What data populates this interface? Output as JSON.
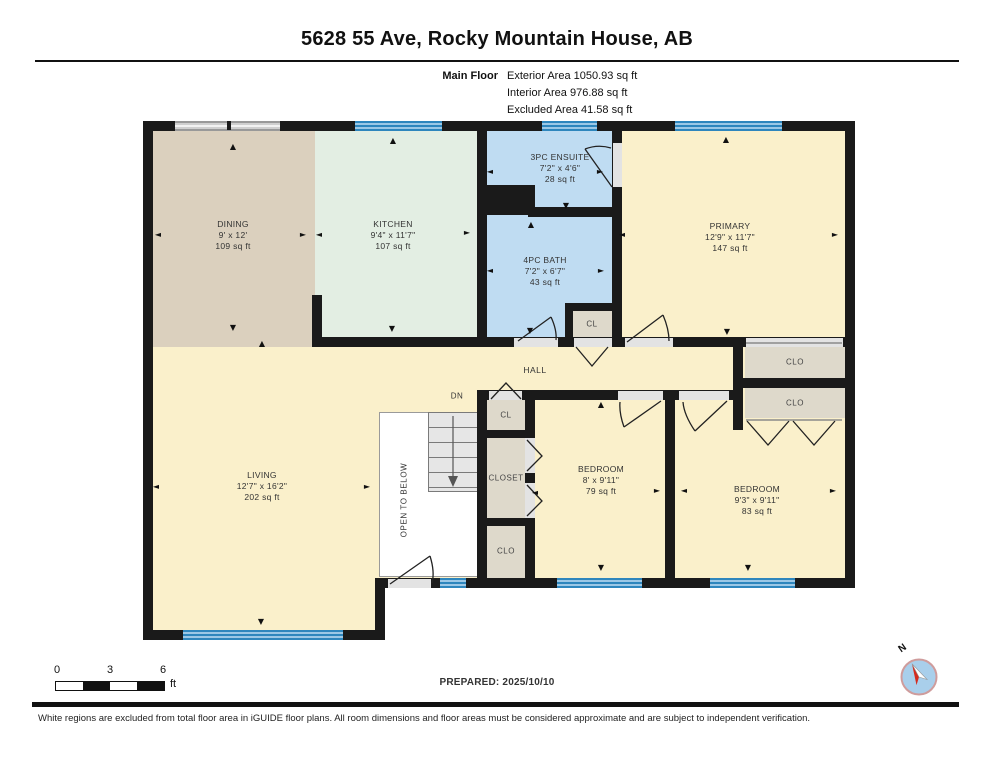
{
  "header": {
    "title": "5628 55 Ave, Rocky Mountain House, AB",
    "floor_label": "Main Floor",
    "stats": [
      "Exterior Area 1050.93 sq ft",
      "Interior Area 976.88 sq ft",
      "Excluded Area 41.58 sq ft"
    ]
  },
  "rooms": {
    "dining": {
      "name": "DINING",
      "dims": "9' x 12'",
      "area": "109 sq ft"
    },
    "kitchen": {
      "name": "KITCHEN",
      "dims": "9'4\" x 11'7\"",
      "area": "107 sq ft"
    },
    "ensuite": {
      "name": "3PC ENSUITE",
      "dims": "7'2\" x 4'6\"",
      "area": "28 sq ft"
    },
    "bath": {
      "name": "4PC BATH",
      "dims": "7'2\" x 6'7\"",
      "area": "43 sq ft"
    },
    "primary": {
      "name": "PRIMARY",
      "dims": "12'9\" x 11'7\"",
      "area": "147 sq ft"
    },
    "living": {
      "name": "LIVING",
      "dims": "12'7\" x 16'2\"",
      "area": "202 sq ft"
    },
    "bedroom1": {
      "name": "BEDROOM",
      "dims": "8' x 9'11\"",
      "area": "79 sq ft"
    },
    "bedroom2": {
      "name": "BEDROOM",
      "dims": "9'3\" x 9'11\"",
      "area": "83 sq ft"
    },
    "hall": {
      "name": "HALL"
    }
  },
  "closets": {
    "cl": "CL",
    "clo": "CLO",
    "closet": "CLOSET"
  },
  "stairs": {
    "dn": "DN",
    "open_to_below": "OPEN TO BELOW"
  },
  "scale": {
    "ticks": [
      "0",
      "3",
      "6"
    ],
    "unit": "ft"
  },
  "footer": {
    "prepared": "PREPARED: 2025/10/10",
    "disclaimer": "White regions are excluded from total floor area in iGUIDE floor plans. All room dimensions and floor areas must be considered approximate and are subject to independent verification."
  },
  "compass": {
    "label": "N"
  },
  "icons": {
    "u": "▲",
    "d": "▼",
    "l": "◄",
    "r": "►"
  },
  "colors": {
    "wall": "#1a1a1a",
    "window": "#2e86bd",
    "room_cream": "#faf0cb",
    "room_dining": "#dbd0be",
    "room_kitchen": "#e3eee3",
    "room_bath": "#bfdcf2",
    "closet_gray": "#ded9cb",
    "compass_fill": "#a9cfeb",
    "compass_needle": "#d42b1e"
  }
}
